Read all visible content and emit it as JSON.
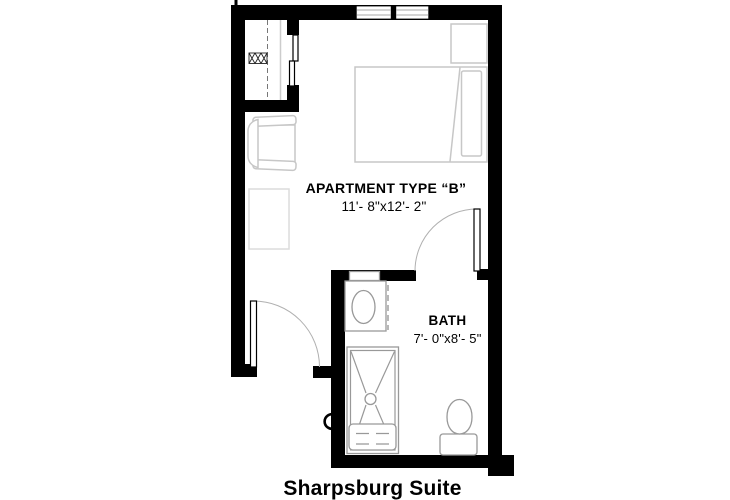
{
  "title": "Sharpsburg Suite",
  "rooms": [
    {
      "name": "APARTMENT TYPE “B”",
      "dimensions": "11'- 8\"x12'- 2\""
    },
    {
      "name": "BATH",
      "dimensions": "7'- 0\"x8'- 5\""
    }
  ],
  "fixtures": [
    "window",
    "window",
    "closet-rod",
    "closet-vent-box",
    "sliding-bypass-door",
    "lounge-chair",
    "side-table",
    "bed",
    "pillow",
    "nightstand",
    "entry-door",
    "bath-door",
    "vanity-sink",
    "mirror-cabinet",
    "shower",
    "shower-bench",
    "toilet",
    "wall-handle"
  ],
  "colors": {
    "walls": "#000000",
    "furniture_line": "#c7c7c7",
    "fixture_line": "#999999",
    "door_arc": "#b0b0b0",
    "text": "#000000",
    "background": "#ffffff"
  }
}
